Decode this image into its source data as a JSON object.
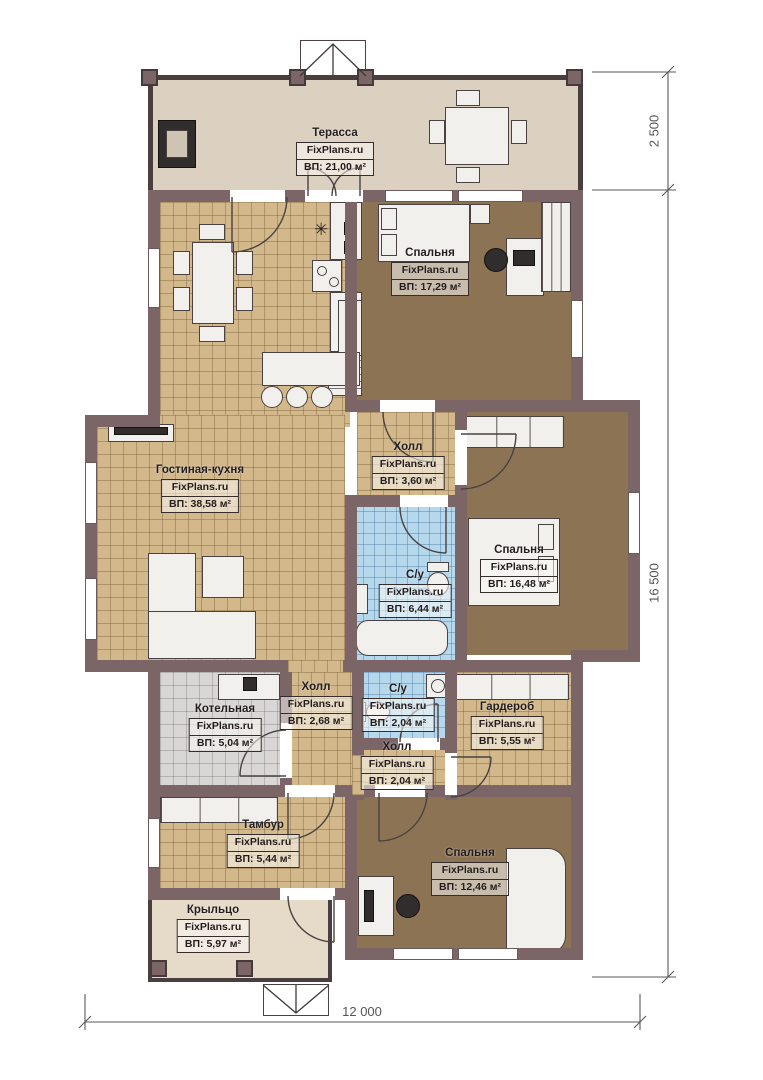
{
  "plan_title": "FixPlans.ru house floor plan",
  "watermark": "FixPlans.ru",
  "colors": {
    "wall": "#7b6566",
    "terrace_floor": "#dcd0c0",
    "tan_tile": "#d2b88b",
    "bedroom_floor": "#8b7354",
    "bath_tile": "#b5d8ec",
    "boiler_tile": "#d8d7d5",
    "porch_floor": "#e6dac9"
  },
  "symbols": {
    "kitchen_star": "✳"
  },
  "dimensions": {
    "right_top": "2 500",
    "right_main": "16 500",
    "bottom": "12 000"
  },
  "rooms": [
    {
      "name": "Терасса",
      "watermark": "FixPlans.ru",
      "area": "ВП: 21,00 м²"
    },
    {
      "name": "Спальня",
      "watermark": "FixPlans.ru",
      "area": "ВП: 17,29 м²"
    },
    {
      "name": "Холл",
      "watermark": "FixPlans.ru",
      "area": "ВП: 3,60 м²"
    },
    {
      "name": "Гостиная-кухня",
      "watermark": "FixPlans.ru",
      "area": "ВП: 38,58 м²"
    },
    {
      "name": "Спальня",
      "watermark": "FixPlans.ru",
      "area": "ВП: 16,48 м²"
    },
    {
      "name": "С/у",
      "watermark": "FixPlans.ru",
      "area": "ВП: 6,44 м²"
    },
    {
      "name": "Котельная",
      "watermark": "FixPlans.ru",
      "area": "ВП: 5,04 м²"
    },
    {
      "name": "Холл",
      "watermark": "FixPlans.ru",
      "area": "ВП: 2,68 м²"
    },
    {
      "name": "С/у",
      "watermark": "FixPlans.ru",
      "area": "ВП: 2,04 м²"
    },
    {
      "name": "Гардероб",
      "watermark": "FixPlans.ru",
      "area": "ВП: 5,55 м²"
    },
    {
      "name": "Холл",
      "watermark": "FixPlans.ru",
      "area": "ВП: 2,04 м²"
    },
    {
      "name": "Тамбур",
      "watermark": "FixPlans.ru",
      "area": "ВП: 5,44 м²"
    },
    {
      "name": "Спальня",
      "watermark": "FixPlans.ru",
      "area": "ВП: 12,46 м²"
    },
    {
      "name": "Крыльцо",
      "watermark": "FixPlans.ru",
      "area": "ВП: 5,97 м²"
    }
  ]
}
